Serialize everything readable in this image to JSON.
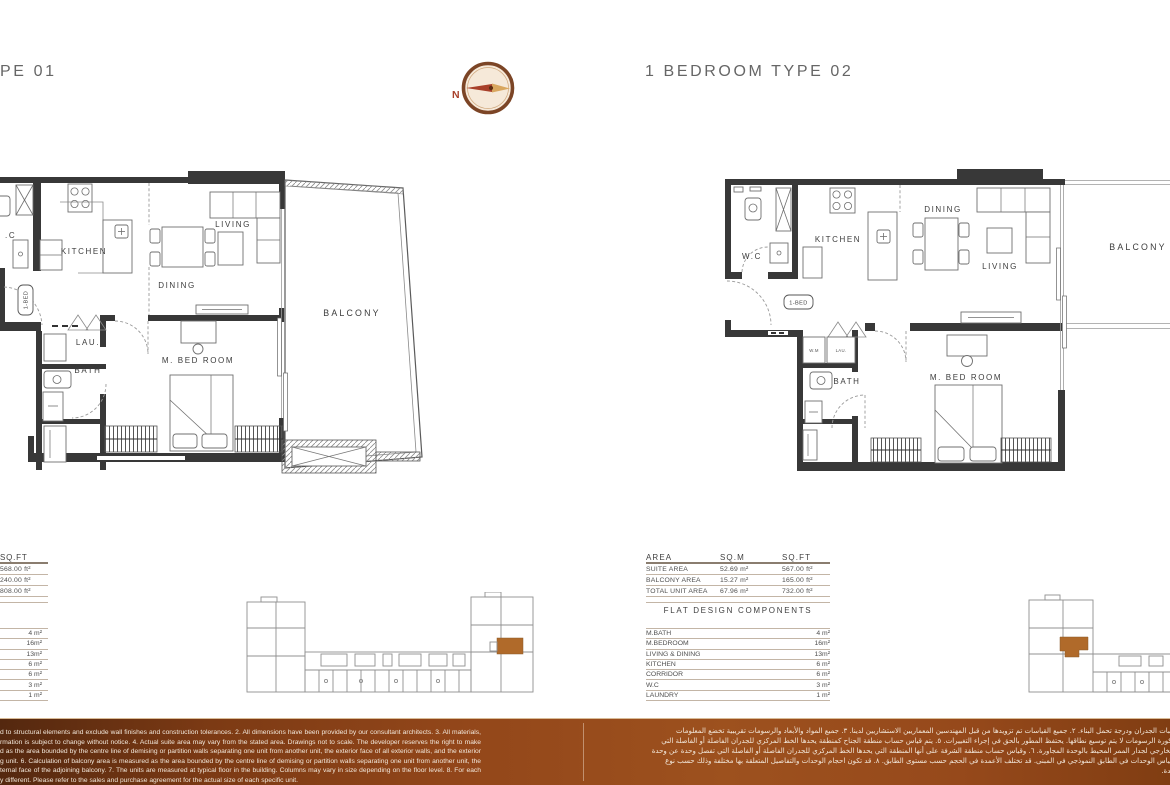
{
  "header": {
    "title_left_visible": "PE 01",
    "title_right": "1 BEDROOM TYPE 02",
    "compass_north": "N"
  },
  "plan_left": {
    "rooms": {
      "wc": ".C",
      "kitchen": "KITCHEN",
      "living": "LIVING",
      "dining": "DINING",
      "balcony": "BALCONY",
      "laundry": "LAU.",
      "bath": "BATH",
      "master_bedroom": "M. BED ROOM",
      "unit_tag": "1-BED"
    }
  },
  "plan_right": {
    "rooms": {
      "wc": "W.C",
      "kitchen": "KITCHEN",
      "dining": "DINING",
      "living": "LIVING",
      "balcony": "BALCONY",
      "washing_machine": "W.M",
      "laundry": "LAU.",
      "bath": "BATH",
      "master_bedroom": "M. BED ROOM",
      "unit_tag": "1-BED"
    }
  },
  "area_table_left": {
    "sqft_header": "SQ.FT",
    "area_sqft_values": [
      "568.00 ft²",
      "240.00 ft²",
      "808.00 ft²"
    ],
    "component_values": [
      "4 m²",
      "16m²",
      "13m²",
      "6 m²",
      "6 m²",
      "3 m²",
      "1 m²"
    ]
  },
  "area_table_right": {
    "headers": [
      "AREA",
      "SQ.M",
      "SQ.FT"
    ],
    "rows": [
      {
        "label": "SUITE AREA",
        "sqm": "52.69 m²",
        "sqft": "567.00 ft²"
      },
      {
        "label": "BALCONY AREA",
        "sqm": "15.27 m²",
        "sqft": "165.00 ft²"
      },
      {
        "label": "TOTAL UNIT AREA",
        "sqm": "67.96 m²",
        "sqft": "732.00 ft²"
      }
    ],
    "components_title": "FLAT DESIGN COMPONENTS",
    "components": [
      {
        "label": "M.BATH",
        "value": "4 m²"
      },
      {
        "label": "M.BEDROOM",
        "value": "16m²"
      },
      {
        "label": "LIVING & DINING",
        "value": "13m²"
      },
      {
        "label": "KITCHEN",
        "value": "6 m²"
      },
      {
        "label": "CORRIDOR",
        "value": "6 m²"
      },
      {
        "label": "W.C",
        "value": "3 m²"
      },
      {
        "label": "LAUNDRY",
        "value": "1 m²"
      }
    ]
  },
  "footer": {
    "english_lines": [
      "d to structural elements and exclude wall finishes and construction tolerances. 2. All dimensions have been provided by our consultant architects. 3. All materials,",
      "rmation is subject to change without notice. 4. Actual suite area may vary from the stated area. Drawings not to scale. The developer reserves the right to make",
      "d as the area bounded by the centre line of demising or partition walls separating one unit from another unit, the exterior face of all exterior walls, and the exterior",
      "g unit. 6. Calculation of balcony area is measured as the area bounded by the centre line of demising or partition walls separating one unit from another unit, the",
      "ternal face of the adjoining balcony. 7. The units are measured at typical floor in the building. Columns may vary in size depending on the floor level. 8. For each",
      "y different. Please refer to the sales and purchase agreement for the actual size of each specific unit."
    ],
    "arabic_lines": [
      "جميع اسعة لتشطيبات الجدران ودرجة تحمل البناء. ٢. جميع القياسات تم تزويدها من قبل المهندسين المعماريين الاستشاريين لدينا. ٣. جميع المواد والأبعاد والرسومات تقريبية تخضع المعلومات",
      "عن المساحة المذكورة الرسومات لا يتم توسيع نطاقها. يحتفظ المطور بالحق في إجراء التغييرات. ٥. يتم قياس حساب منطقة الجناح كمنطقة يحدها الخط المركزي للجدران الفاصلة أو الفاصلة التي",
      "الخارجية والوجه الخارجي لجدار الممر المحيط بالوحدة المجاورة. ٦. وقياس حساب منطقة الشرفة على أنها المنطقة التي يحدها الخط المركزي للجدران الفاصلة أو الفاصلة التي تفصل وحدة عن وحدة",
      "المجاورة. ٧. يتم قياس الوحدات في الطابق النموذجي في المبنى. قد تختلف الأعمدة في الحجم حسب مستوى الطابق. ٨. قد تكون احجام الوحدات والتفاصيل المتعلقة بها مختلفة وذلك حسب نوع",
      "ام الفعلي لكل وحدة."
    ],
    "colors": {
      "band_left": "#54280f",
      "band_mid": "#9a4e1c",
      "band_right": "#803d12",
      "text": "#f2e7da"
    }
  },
  "key_plans": {
    "highlight_color": "#b06a2a"
  }
}
